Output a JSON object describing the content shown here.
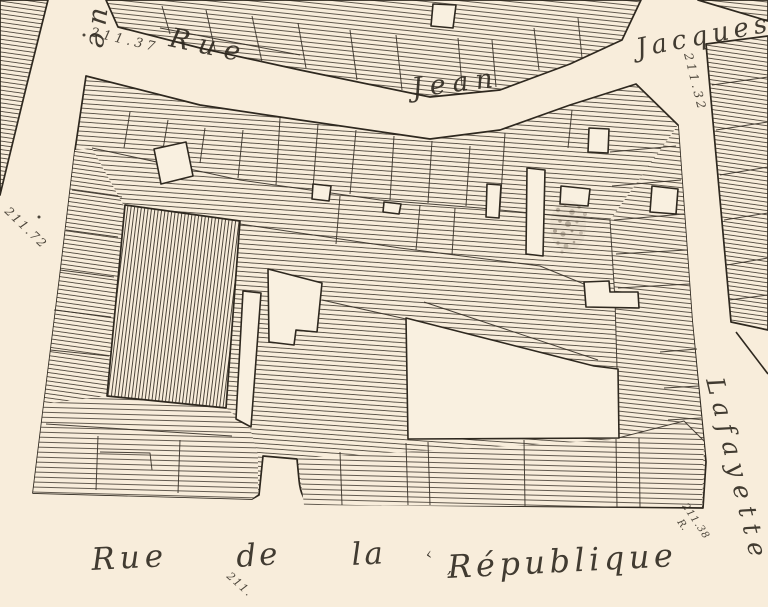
{
  "labels": {
    "street_left": "Rue",
    "street_top_rue": "Rue",
    "street_top_jean": "Jean",
    "street_top_jacques": "Jacques",
    "street_right": "Lafayette",
    "bottom_rue": "Rue",
    "bottom_de": "de",
    "bottom_la": "la",
    "bottom_republique": "République",
    "bottom_lead_mark": "‹",
    "bottom_comma_mark": ","
  },
  "elevations": {
    "top_left": "211.37",
    "top_right": "211.32",
    "left": "211.72",
    "bottom_center": "211.",
    "bottom_right_value": "211.38",
    "bottom_right_suffix": "R."
  },
  "colors": {
    "paper": "#f8eddb",
    "ink": "#2e281f",
    "hatch": "#3d362c",
    "building": "#f9f0e0"
  }
}
